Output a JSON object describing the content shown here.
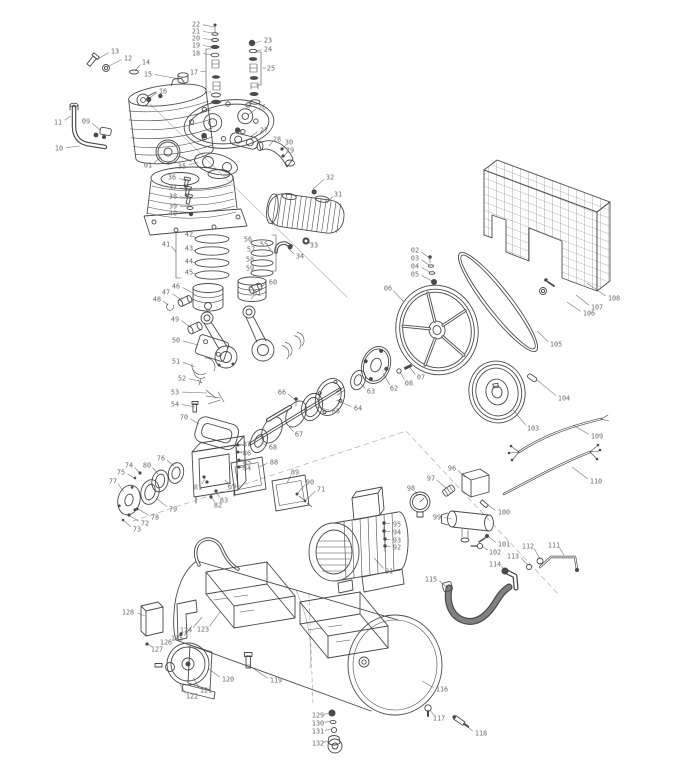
{
  "figure": {
    "kind": "exploded-parts-diagram",
    "background": "#ffffff",
    "ink": "#4a4a4a",
    "label_color": "#6a6a6a"
  },
  "callouts": [
    {
      "n": "01",
      "x": 148,
      "y": 165,
      "tx": 161,
      "ty": 157
    },
    {
      "n": "02",
      "x": 415,
      "y": 250,
      "tx": 428,
      "ty": 257
    },
    {
      "n": "03",
      "x": 415,
      "y": 258,
      "tx": 429,
      "ty": 265
    },
    {
      "n": "04",
      "x": 415,
      "y": 266,
      "tx": 430,
      "ty": 272
    },
    {
      "n": "05",
      "x": 415,
      "y": 274,
      "tx": 432,
      "ty": 281
    },
    {
      "n": "06",
      "x": 388,
      "y": 288,
      "tx": 404,
      "ty": 302
    },
    {
      "n": "07",
      "x": 421,
      "y": 377,
      "tx": 410,
      "ty": 368
    },
    {
      "n": "08",
      "x": 409,
      "y": 383,
      "tx": 400,
      "ty": 372
    },
    {
      "n": "09",
      "x": 86,
      "y": 121,
      "tx": 100,
      "ty": 130
    },
    {
      "n": "10",
      "x": 59,
      "y": 148,
      "tx": 80,
      "ty": 146
    },
    {
      "n": "11",
      "x": 58,
      "y": 122,
      "tx": 71,
      "ty": 116
    },
    {
      "n": "12",
      "x": 128,
      "y": 58,
      "tx": 107,
      "ty": 67
    },
    {
      "n": "13",
      "x": 115,
      "y": 51,
      "tx": 94,
      "ty": 61
    },
    {
      "n": "14",
      "x": 146,
      "y": 62,
      "tx": 135,
      "ty": 71
    },
    {
      "n": "15",
      "x": 148,
      "y": 74,
      "tx": 180,
      "ty": 79
    },
    {
      "n": "16",
      "x": 163,
      "y": 91,
      "tx": 148,
      "ty": 99
    },
    {
      "n": "17",
      "x": 194,
      "y": 72,
      "tx": 206,
      "ty": 71
    },
    {
      "n": "18",
      "x": 196,
      "y": 53,
      "tx": 212,
      "ty": 55
    },
    {
      "n": "19",
      "x": 196,
      "y": 45,
      "tx": 212,
      "ty": 47
    },
    {
      "n": "20",
      "x": 196,
      "y": 38,
      "tx": 213,
      "ty": 40
    },
    {
      "n": "21",
      "x": 196,
      "y": 31,
      "tx": 213,
      "ty": 33
    },
    {
      "n": "22",
      "x": 196,
      "y": 24,
      "tx": 214,
      "ty": 27
    },
    {
      "n": "23",
      "x": 268,
      "y": 40,
      "tx": 255,
      "ty": 43
    },
    {
      "n": "24",
      "x": 268,
      "y": 49,
      "tx": 256,
      "ty": 51
    },
    {
      "n": "25",
      "x": 271,
      "y": 68,
      "tx": 262,
      "ty": 68
    },
    {
      "n": "26",
      "x": 262,
      "y": 107,
      "tx": 248,
      "ty": 115
    },
    {
      "n": "27",
      "x": 264,
      "y": 130,
      "tx": 250,
      "ty": 137
    },
    {
      "n": "28",
      "x": 277,
      "y": 139,
      "tx": 269,
      "ty": 146
    },
    {
      "n": "29",
      "x": 290,
      "y": 150,
      "tx": 284,
      "ty": 156
    },
    {
      "n": "30",
      "x": 289,
      "y": 142,
      "tx": 283,
      "ty": 149
    },
    {
      "n": "31",
      "x": 338,
      "y": 194,
      "tx": 327,
      "ty": 203
    },
    {
      "n": "32",
      "x": 330,
      "y": 177,
      "tx": 313,
      "ty": 189
    },
    {
      "n": "33",
      "x": 314,
      "y": 245,
      "tx": 308,
      "ty": 242
    },
    {
      "n": "34",
      "x": 300,
      "y": 256,
      "tx": 289,
      "ty": 249
    },
    {
      "n": "35",
      "x": 182,
      "y": 166,
      "tx": 198,
      "ty": 162
    },
    {
      "n": "36",
      "x": 172,
      "y": 177,
      "tx": 186,
      "ty": 181
    },
    {
      "n": "37",
      "x": 173,
      "y": 187,
      "tx": 187,
      "ty": 190
    },
    {
      "n": "38",
      "x": 173,
      "y": 196,
      "tx": 188,
      "ty": 198
    },
    {
      "n": "39",
      "x": 173,
      "y": 206,
      "tx": 189,
      "ty": 207
    },
    {
      "n": "40",
      "x": 173,
      "y": 213,
      "tx": 190,
      "ty": 213
    },
    {
      "n": "41",
      "x": 166,
      "y": 244,
      "tx": 176,
      "ty": 252
    },
    {
      "n": "42",
      "x": 189,
      "y": 234,
      "tx": 196,
      "ty": 238
    },
    {
      "n": "43",
      "x": 189,
      "y": 248,
      "tx": 196,
      "ty": 251
    },
    {
      "n": "44",
      "x": 189,
      "y": 261,
      "tx": 196,
      "ty": 263
    },
    {
      "n": "45",
      "x": 189,
      "y": 272,
      "tx": 196,
      "ty": 274
    },
    {
      "n": "46",
      "x": 176,
      "y": 286,
      "tx": 193,
      "ty": 293
    },
    {
      "n": "47",
      "x": 166,
      "y": 292,
      "tx": 180,
      "ty": 299
    },
    {
      "n": "48",
      "x": 157,
      "y": 299,
      "tx": 168,
      "ty": 305
    },
    {
      "n": "49",
      "x": 175,
      "y": 319,
      "tx": 189,
      "ty": 326
    },
    {
      "n": "50",
      "x": 176,
      "y": 340,
      "tx": 198,
      "ty": 345
    },
    {
      "n": "51",
      "x": 176,
      "y": 361,
      "tx": 195,
      "ty": 367
    },
    {
      "n": "52",
      "x": 182,
      "y": 378,
      "tx": 199,
      "ty": 381
    },
    {
      "n": "53",
      "x": 175,
      "y": 392,
      "tx": 207,
      "ty": 393
    },
    {
      "n": "54",
      "x": 175,
      "y": 404,
      "tx": 195,
      "ty": 407
    },
    {
      "n": "55",
      "x": 264,
      "y": 244,
      "tx": 271,
      "ty": 250
    },
    {
      "n": "56",
      "x": 248,
      "y": 239,
      "tx": 252,
      "ty": 242
    },
    {
      "n": "57",
      "x": 251,
      "y": 249,
      "tx": 252,
      "ty": 252
    },
    {
      "n": "58",
      "x": 250,
      "y": 259,
      "tx": 252,
      "ty": 262
    },
    {
      "n": "59",
      "x": 250,
      "y": 268,
      "tx": 252,
      "ty": 271
    },
    {
      "n": "60",
      "x": 273,
      "y": 282,
      "tx": 260,
      "ty": 287
    },
    {
      "n": "61",
      "x": 257,
      "y": 293,
      "tx": 251,
      "ty": 299
    },
    {
      "n": "62",
      "x": 394,
      "y": 388,
      "tx": 383,
      "ty": 373
    },
    {
      "n": "63",
      "x": 371,
      "y": 391,
      "tx": 360,
      "ty": 383
    },
    {
      "n": "64",
      "x": 358,
      "y": 408,
      "tx": 336,
      "ty": 400
    },
    {
      "n": "65",
      "x": 336,
      "y": 411,
      "tx": 317,
      "ty": 407
    },
    {
      "n": "66",
      "x": 282,
      "y": 392,
      "tx": 294,
      "ty": 399
    },
    {
      "n": "67",
      "x": 299,
      "y": 434,
      "tx": 289,
      "ty": 427
    },
    {
      "n": "68",
      "x": 273,
      "y": 447,
      "tx": 262,
      "ty": 443
    },
    {
      "n": "69",
      "x": 232,
      "y": 486,
      "tx": 225,
      "ty": 480
    },
    {
      "n": "70",
      "x": 184,
      "y": 417,
      "tx": 199,
      "ty": 424
    },
    {
      "n": "71",
      "x": 321,
      "y": 489,
      "tx": 306,
      "ty": 500
    },
    {
      "n": "72",
      "x": 145,
      "y": 523,
      "tx": 130,
      "ty": 516
    },
    {
      "n": "73",
      "x": 137,
      "y": 529,
      "tx": 124,
      "ty": 521
    },
    {
      "n": "74",
      "x": 129,
      "y": 465,
      "tx": 139,
      "ty": 472
    },
    {
      "n": "75",
      "x": 121,
      "y": 472,
      "tx": 134,
      "ty": 478
    },
    {
      "n": "76",
      "x": 161,
      "y": 458,
      "tx": 174,
      "ty": 466
    },
    {
      "n": "77",
      "x": 113,
      "y": 481,
      "tx": 124,
      "ty": 492
    },
    {
      "n": "78",
      "x": 155,
      "y": 517,
      "tx": 138,
      "ty": 509
    },
    {
      "n": "79",
      "x": 173,
      "y": 509,
      "tx": 156,
      "ty": 498
    },
    {
      "n": "80",
      "x": 147,
      "y": 465,
      "tx": 158,
      "ty": 474
    },
    {
      "n": "81",
      "x": 198,
      "y": 487,
      "tx": 205,
      "ty": 479
    },
    {
      "n": "82",
      "x": 218,
      "y": 505,
      "tx": 212,
      "ty": 498
    },
    {
      "n": "83",
      "x": 224,
      "y": 500,
      "tx": 216,
      "ty": 492
    },
    {
      "n": "84",
      "x": 247,
      "y": 468,
      "tx": 239,
      "ty": 467
    },
    {
      "n": "85",
      "x": 247,
      "y": 462,
      "tx": 239,
      "ty": 460
    },
    {
      "n": "86",
      "x": 247,
      "y": 453,
      "tx": 238,
      "ty": 452
    },
    {
      "n": "87",
      "x": 247,
      "y": 444,
      "tx": 238,
      "ty": 445
    },
    {
      "n": "88",
      "x": 274,
      "y": 462,
      "tx": 259,
      "ty": 467
    },
    {
      "n": "89",
      "x": 295,
      "y": 472,
      "tx": 287,
      "ty": 483
    },
    {
      "n": "90",
      "x": 310,
      "y": 482,
      "tx": 298,
      "ty": 493
    },
    {
      "n": "91",
      "x": 389,
      "y": 571,
      "tx": 374,
      "ty": 558
    },
    {
      "n": "92",
      "x": 397,
      "y": 547,
      "tx": 386,
      "ty": 546
    },
    {
      "n": "93",
      "x": 397,
      "y": 540,
      "tx": 385,
      "ty": 539
    },
    {
      "n": "94",
      "x": 397,
      "y": 532,
      "tx": 385,
      "ty": 531
    },
    {
      "n": "95",
      "x": 397,
      "y": 524,
      "tx": 384,
      "ty": 523
    },
    {
      "n": "96",
      "x": 452,
      "y": 468,
      "tx": 465,
      "ty": 477
    },
    {
      "n": "97",
      "x": 431,
      "y": 478,
      "tx": 446,
      "ty": 488
    },
    {
      "n": "98",
      "x": 411,
      "y": 488,
      "tx": 418,
      "ty": 496
    },
    {
      "n": "99",
      "x": 437,
      "y": 517,
      "tx": 452,
      "ty": 519
    },
    {
      "n": "100",
      "x": 504,
      "y": 512,
      "tx": 488,
      "ty": 505
    },
    {
      "n": "101",
      "x": 504,
      "y": 544,
      "tx": 489,
      "ty": 537
    },
    {
      "n": "102",
      "x": 495,
      "y": 552,
      "tx": 482,
      "ty": 546
    },
    {
      "n": "103",
      "x": 533,
      "y": 428,
      "tx": 513,
      "ty": 410
    },
    {
      "n": "104",
      "x": 564,
      "y": 398,
      "tx": 537,
      "ty": 380
    },
    {
      "n": "105",
      "x": 556,
      "y": 344,
      "tx": 537,
      "ty": 331
    },
    {
      "n": "106",
      "x": 589,
      "y": 313,
      "tx": 567,
      "ty": 302
    },
    {
      "n": "107",
      "x": 597,
      "y": 307,
      "tx": 576,
      "ty": 295
    },
    {
      "n": "108",
      "x": 614,
      "y": 298,
      "tx": 587,
      "ty": 283
    },
    {
      "n": "109",
      "x": 597,
      "y": 436,
      "tx": 573,
      "ty": 425
    },
    {
      "n": "110",
      "x": 596,
      "y": 481,
      "tx": 572,
      "ty": 467
    },
    {
      "n": "111",
      "x": 554,
      "y": 545,
      "tx": 564,
      "ty": 555
    },
    {
      "n": "112",
      "x": 528,
      "y": 546,
      "tx": 540,
      "ty": 559
    },
    {
      "n": "113",
      "x": 513,
      "y": 556,
      "tx": 528,
      "ty": 565
    },
    {
      "n": "114",
      "x": 495,
      "y": 564,
      "tx": 507,
      "ty": 573
    },
    {
      "n": "115",
      "x": 431,
      "y": 579,
      "tx": 448,
      "ty": 588
    },
    {
      "n": "116",
      "x": 442,
      "y": 689,
      "tx": 422,
      "ty": 681
    },
    {
      "n": "117",
      "x": 439,
      "y": 718,
      "tx": 430,
      "ty": 710
    },
    {
      "n": "118",
      "x": 481,
      "y": 733,
      "tx": 463,
      "ty": 723
    },
    {
      "n": "119",
      "x": 276,
      "y": 680,
      "tx": 251,
      "ty": 667
    },
    {
      "n": "120",
      "x": 228,
      "y": 679,
      "tx": 209,
      "ty": 669
    },
    {
      "n": "121",
      "x": 206,
      "y": 690,
      "tx": 193,
      "ty": 678
    },
    {
      "n": "122",
      "x": 192,
      "y": 696,
      "tx": 180,
      "ty": 684
    },
    {
      "n": "123",
      "x": 203,
      "y": 629,
      "tx": 220,
      "ty": 612
    },
    {
      "n": "124",
      "x": 186,
      "y": 630,
      "tx": 202,
      "ty": 617
    },
    {
      "n": "125",
      "x": 177,
      "y": 638,
      "tx": 192,
      "ty": 626
    },
    {
      "n": "126",
      "x": 166,
      "y": 642,
      "tx": 181,
      "ty": 634
    },
    {
      "n": "127",
      "x": 157,
      "y": 649,
      "tx": 148,
      "ty": 644
    },
    {
      "n": "128",
      "x": 128,
      "y": 612,
      "tx": 145,
      "ty": 616
    },
    {
      "n": "129",
      "x": 318,
      "y": 715,
      "tx": 329,
      "ty": 713
    },
    {
      "n": "130",
      "x": 318,
      "y": 723,
      "tx": 330,
      "ty": 721
    },
    {
      "n": "131",
      "x": 318,
      "y": 731,
      "tx": 331,
      "ty": 729
    },
    {
      "n": "132",
      "x": 318,
      "y": 743,
      "tx": 328,
      "ty": 741
    }
  ]
}
